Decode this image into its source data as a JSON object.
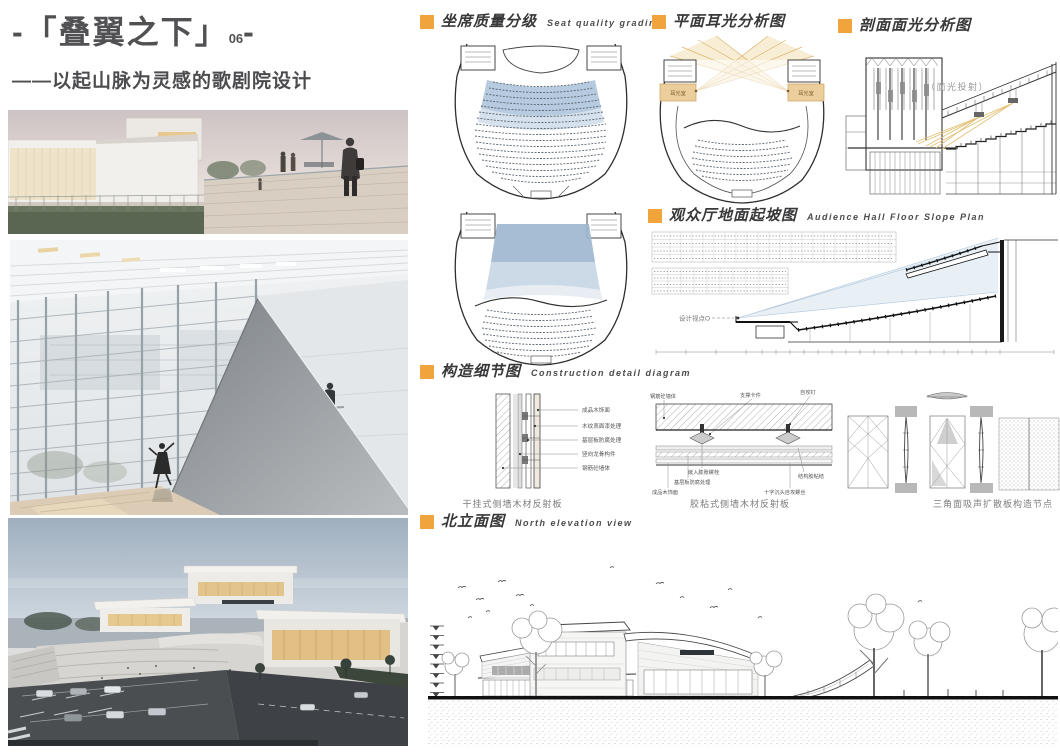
{
  "poster": {
    "title_open": "-「",
    "title_main": "叠翼之下",
    "title_close": "」",
    "title_index": "06",
    "title_end": "-",
    "subtitle": "——以起山脉为灵感的歌剧院设计"
  },
  "sections": {
    "seat_grading": {
      "zh": "坐席质量分级",
      "en": "Seat quality grading"
    },
    "plan_ear_light": {
      "zh": "平面耳光分析图",
      "en": ""
    },
    "section_face_light": {
      "zh": "剖面面光分析图",
      "en": ""
    },
    "floor_slope": {
      "zh": "观众厅地面起坡图",
      "en": "Audience Hall Floor Slope Plan"
    },
    "construction_detail": {
      "zh": "构造细节图",
      "en": "Construction detail diagram"
    },
    "north_elevation": {
      "zh": "北立面图",
      "en": "North elevation view"
    }
  },
  "labels": {
    "face_light_projection": "（面光投射）",
    "ear_room_left": "耳光室",
    "ear_room_right": "耳光室",
    "design_viewpoint": "设计视点O"
  },
  "details": {
    "caption_1": "干挂式侧墙木材反射板",
    "caption_2": "胶粘式侧墙木材反射板",
    "caption_3": "三角面吸声扩散板构造节点",
    "d1_callouts": [
      "成品木饰面",
      "木纹表面漆处理",
      "基层板防腐处理",
      "竖向龙骨构件",
      "钢筋砼墙体"
    ],
    "d2_top_callouts": [
      "钢筋砼墙体",
      "支撑卡件",
      "自攻钉"
    ],
    "d2_bottom_callouts": [
      "嵌入膨胀螺栓",
      "基层板防腐处理",
      "成品木饰面",
      "结构胶粘结",
      "十字沉头自攻螺丝"
    ]
  },
  "colors": {
    "accent_orange": "#F2A43C",
    "seat_zone_blue": "#A9C2D9",
    "seat_zone_light_blue": "#CBD9E7",
    "beam_tan": "#F2DCAC",
    "sightline_blue": "#D6E3EF",
    "title_gray": "#515154"
  }
}
